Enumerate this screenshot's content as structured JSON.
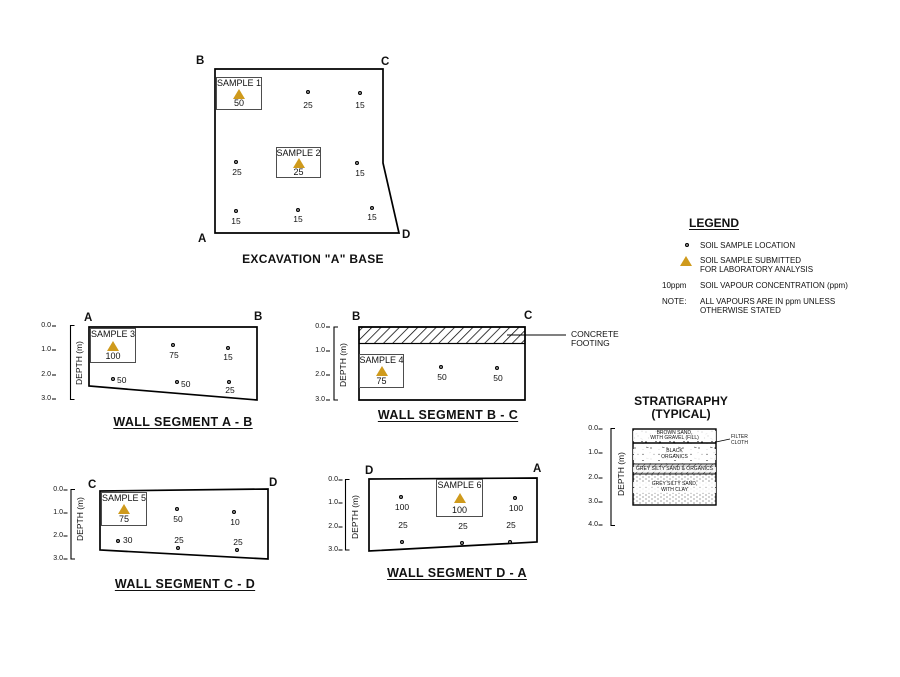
{
  "excavation_base": {
    "title": "EXCAVATION \"A\" BASE",
    "corner_b": "B",
    "corner_c": "C",
    "corner_a": "A",
    "corner_d": "D",
    "sample_1": {
      "label": "SAMPLE 1",
      "value": "50"
    },
    "sample_2": {
      "label": "SAMPLE 2",
      "value": "25"
    },
    "points": [
      {
        "value": "25"
      },
      {
        "value": "15"
      },
      {
        "value": "25"
      },
      {
        "value": "15"
      },
      {
        "value": "15"
      },
      {
        "value": "15"
      },
      {
        "value": "15"
      }
    ]
  },
  "legend": {
    "title": "LEGEND",
    "soil_sample_location": "SOIL SAMPLE LOCATION",
    "submitted_line1": "SOIL SAMPLE SUBMITTED",
    "submitted_line2": "FOR LABORATORY ANALYSIS",
    "vapour_key": "10ppm",
    "vapour_text": "SOIL VAPOUR CONCENTRATION (ppm)",
    "note_key": "NOTE:",
    "note_line1": "ALL VAPOURS ARE IN ppm UNLESS",
    "note_line2": "OTHERWISE STATED"
  },
  "depth_axis": {
    "label": "DEPTH (m)",
    "wall_ticks": [
      "0.0",
      "1.0",
      "2.0",
      "3.0"
    ],
    "strat_ticks": [
      "0.0",
      "1.0",
      "2.0",
      "3.0",
      "4.0"
    ]
  },
  "wall_ab": {
    "title": "WALL SEGMENT A - B",
    "corner_left": "A",
    "corner_right": "B",
    "sample": {
      "label": "SAMPLE 3",
      "value": "100"
    },
    "points": [
      {
        "value": "75"
      },
      {
        "value": "15"
      },
      {
        "value": "50"
      },
      {
        "value": "50"
      },
      {
        "value": "25"
      }
    ]
  },
  "wall_bc": {
    "title": "WALL SEGMENT B - C",
    "corner_left": "B",
    "corner_right": "C",
    "sample": {
      "label": "SAMPLE 4",
      "value": "75"
    },
    "points": [
      {
        "value": "50"
      },
      {
        "value": "50"
      }
    ],
    "footing_line1": "CONCRETE",
    "footing_line2": "FOOTING"
  },
  "wall_cd": {
    "title": "WALL SEGMENT C - D",
    "corner_left": "C",
    "corner_right": "D",
    "sample": {
      "label": "SAMPLE 5",
      "value": "75"
    },
    "points": [
      {
        "value": "50"
      },
      {
        "value": "10"
      },
      {
        "value": "30"
      },
      {
        "value": "25"
      },
      {
        "value": "25"
      }
    ]
  },
  "wall_da": {
    "title": "WALL SEGMENT D - A",
    "corner_left": "D",
    "corner_right": "A",
    "sample": {
      "label": "SAMPLE 6",
      "value": "100"
    },
    "points": [
      {
        "value": "100"
      },
      {
        "value": "100"
      },
      {
        "value": "25"
      },
      {
        "value": "25"
      },
      {
        "value": "25"
      }
    ]
  },
  "stratigraphy": {
    "title_line1": "STRATIGRAPHY",
    "title_line2": "(TYPICAL)",
    "filter_cloth_line1": "FILTER",
    "filter_cloth_line2": "CLOTH",
    "layer1_line1": "BROWN SAND,",
    "layer1_line2": "WITH GRAVEL (FILL)",
    "layer2_line1": "BLACK",
    "layer2_line2": "ORGANICS",
    "layer3": "GREY SILTY SAND & ORGANICS",
    "layer4_line1": "GREY SILTY SAND,",
    "layer4_line2": "WITH CLAY"
  },
  "colors": {
    "sample_triangle": "#cf9a1c",
    "line": "#000000"
  }
}
